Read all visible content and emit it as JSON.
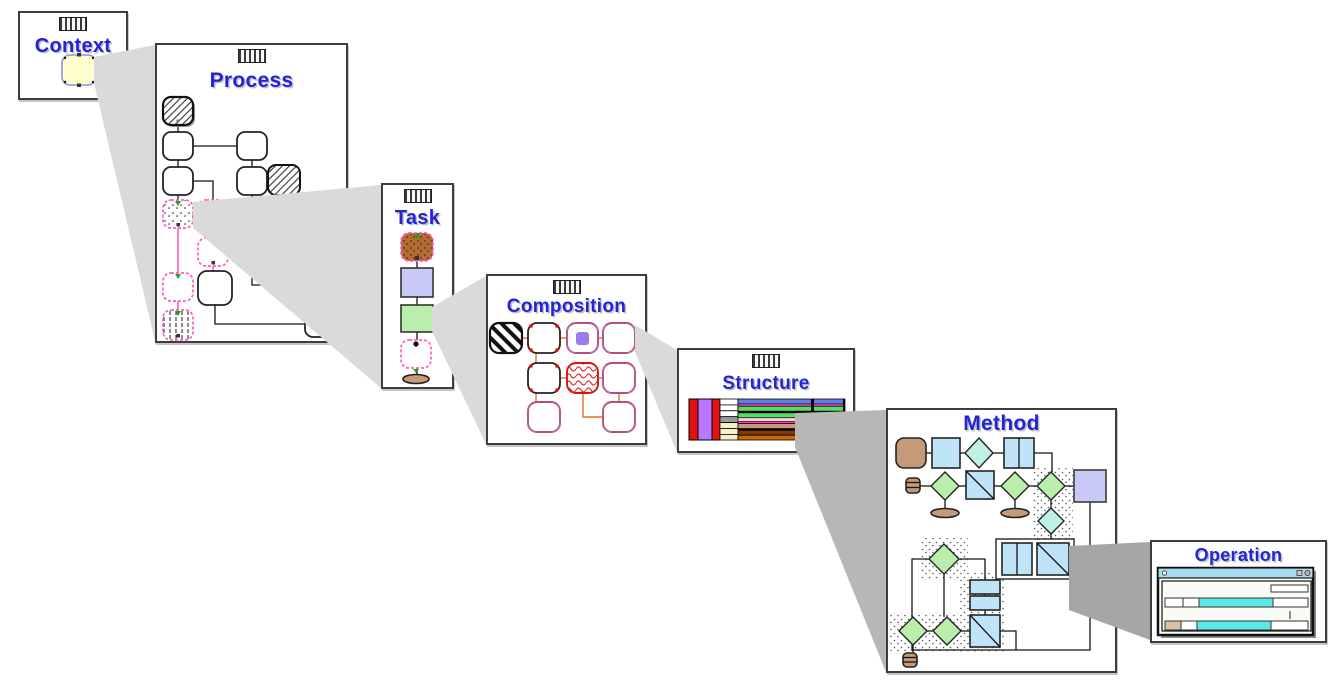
{
  "figure": {
    "type": "cascading-zoom-diagram",
    "description": "Nested editor windows, each node expanding into the next window via gray beams"
  },
  "windows": [
    {
      "id": "context",
      "title": "Context",
      "grip_icon": true
    },
    {
      "id": "process",
      "title": "Process",
      "grip_icon": true
    },
    {
      "id": "task",
      "title": "Task",
      "grip_icon": true
    },
    {
      "id": "composition",
      "title": "Composition",
      "grip_icon": true
    },
    {
      "id": "structure",
      "title": "Structure",
      "grip_icon": true
    },
    {
      "id": "method",
      "title": "Method",
      "grip_icon": false
    },
    {
      "id": "operation",
      "title": "Operation",
      "grip_icon": false
    }
  ],
  "beams": [
    {
      "from": "context",
      "to": "process",
      "shade": "light"
    },
    {
      "from": "process",
      "to": "task",
      "shade": "light"
    },
    {
      "from": "task",
      "to": "composition",
      "shade": "light"
    },
    {
      "from": "composition",
      "to": "structure",
      "shade": "light"
    },
    {
      "from": "structure",
      "to": "method",
      "shade": "mid"
    },
    {
      "from": "method",
      "to": "operation",
      "shade": "dark"
    }
  ],
  "colors": {
    "title_blue": "#2323d7",
    "beam_light": "#dadada",
    "beam_mid": "#b7b7b7",
    "beam_dark": "#a6a6a6",
    "pale_yellow": "#ffffcf",
    "lavender": "#c9c9f7",
    "lt_green": "#b9efab",
    "lt_blue": "#bfe3f7",
    "teal": "#bff0e4",
    "brown": "#c49a78",
    "brown_dark": "#b06d35",
    "pink": "#ff5cc0",
    "red": "#dd1111",
    "orange_line": "#e07030",
    "purple_bar": "#bb77ff",
    "struct_red": "#e01212",
    "bar_blue": "#5f7fe8",
    "bar_green": "#55dd66",
    "bar_magenta": "#ff44cc",
    "bar_palepink": "#ffd0dd",
    "bar_tan": "#c89878",
    "bar_brown": "#7a3c00",
    "bar_orange": "#cc6600",
    "cyan": "#5ce8e8",
    "titlebar_blue": "#a8dcf0"
  }
}
